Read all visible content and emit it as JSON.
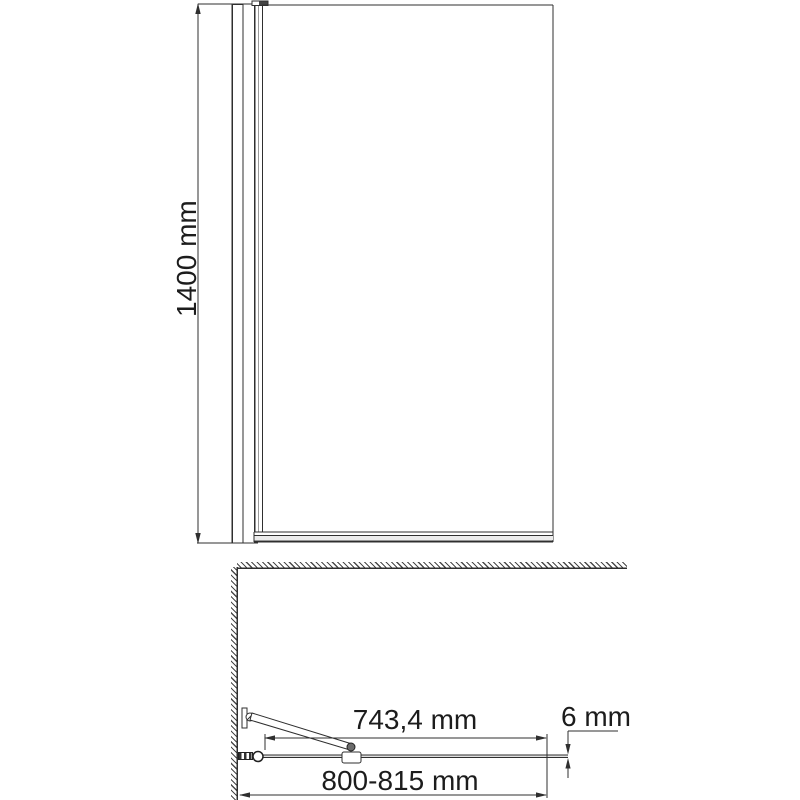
{
  "drawing": {
    "kind": "shower-screen-technical-drawing",
    "colors": {
      "background": "#ffffff",
      "line": "#2f2f2f",
      "gray_line": "#9a9a9a",
      "text": "#1c1c1c"
    },
    "front_view": {
      "height_dimension": {
        "label": "1400 mm",
        "value_mm": 1400
      }
    },
    "plan_view": {
      "glass_width_dimension": {
        "label": "743,4 mm",
        "value_mm": 743.4
      },
      "overall_width_dimension": {
        "label": "800-815 mm",
        "min_mm": 800,
        "max_mm": 815
      },
      "glass_thickness_dimension": {
        "label": "6 mm",
        "value_mm": 6
      }
    }
  }
}
